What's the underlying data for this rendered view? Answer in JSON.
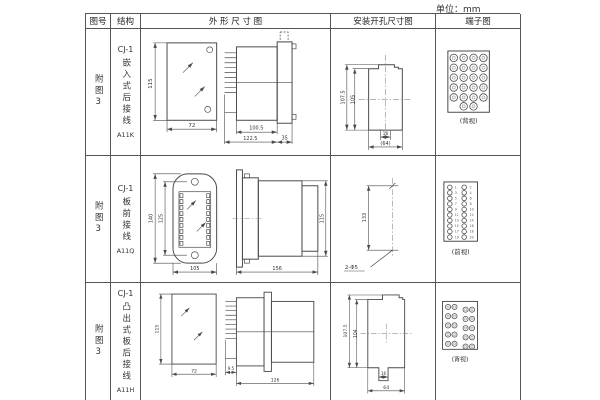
{
  "page": {
    "unit_label": "单位：mm"
  },
  "table": {
    "headers": {
      "fig": "图号",
      "structure": "结构",
      "outline": "外 形 尺 寸 图",
      "mounting": "安装开孔尺寸图",
      "terminal": "端子图"
    },
    "rows": [
      {
        "fig_no": "附图3",
        "model": "CJ-1",
        "type": "嵌入式后接线",
        "code": "A11K",
        "outline": {
          "front_height": "115",
          "front_width": "72",
          "body_depth": "100.5",
          "total_depth": "122.5",
          "flange_depth": "35"
        },
        "mounting": {
          "outer_height": "107.5",
          "inner_height": "105",
          "hole_span": "16",
          "width": "(64)"
        },
        "terminal": {
          "view": "(背视)"
        }
      },
      {
        "fig_no": "附图3",
        "model": "CJ-1",
        "type": "板前接线",
        "code": "A11Q",
        "outline": {
          "front_height": "140",
          "inner_height": "125",
          "front_width": "105",
          "side_length": "156",
          "side_height": "115"
        },
        "mounting": {
          "hole_distance": "133",
          "hole_label": "2-Φ5"
        },
        "terminal": {
          "view": "(前视)",
          "left_numbers": [
            "1",
            "3",
            "5",
            "7",
            "9",
            "11",
            "13",
            "15",
            "17",
            "19"
          ],
          "right_numbers": [
            "2",
            "4",
            "6",
            "8",
            "10",
            "12",
            "14",
            "16",
            "18",
            "20"
          ]
        }
      },
      {
        "fig_no": "附图3",
        "model": "CJ-1",
        "type": "凸出式板后接线",
        "code": "A11H",
        "outline": {
          "front_height": "115",
          "front_width": "72",
          "pin_depth": "9.5",
          "total_depth": "126"
        },
        "mounting": {
          "outer_height": "107.5",
          "inner_height": "104",
          "slot_width": "16",
          "width": "64"
        },
        "terminal": {
          "view": "(背视)"
        }
      }
    ]
  }
}
